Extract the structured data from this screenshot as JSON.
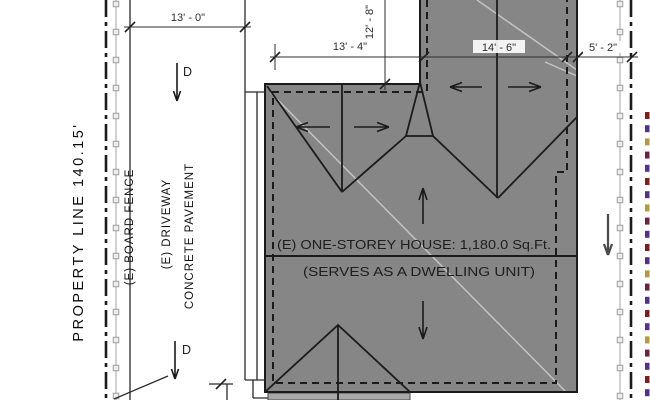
{
  "colors": {
    "background": "#ffffff",
    "house_fill": "#868686",
    "porch_fill": "#a9a9a9",
    "outline": "#1b1b1b",
    "fence": "#c2c2c2",
    "fence_post_fill": "#ededed",
    "fence_post_stroke": "#9e9e9e",
    "dim": "#2e2e2e",
    "drain_arrow": "#4a4a4a",
    "faint_roof_line": "rgba(255,255,255,0.5)"
  },
  "labels": {
    "property_line_left": "PROPERTY LINE  140.15'",
    "board_fence": "(E) BOARD FENCE",
    "driveway_line1": "(E) DRIVEWAY",
    "driveway_line2": "CONCRETE PAVEMENT",
    "house_line1": "(E) ONE-STOREY HOUSE: 1,180.0  Sq.Ft.",
    "house_line2": "(SERVES AS A DWELLING UNIT)",
    "drain_top": "D",
    "drain_bottom": "D"
  },
  "dimensions": {
    "driveway_width": "13' - 0\"",
    "left_segment": "13' - 4\"",
    "mid_segment": "14' - 6\"",
    "right_segment": "5' - 2\"",
    "upper_offset": "12' - 8\""
  },
  "fences": {
    "left_x": 116,
    "right_x": 620,
    "post_start_y": 4,
    "post_spacing": 28,
    "post_size": 5.5
  },
  "right_edge_marks": {
    "x": 645,
    "width": 4.5,
    "height": 7,
    "y_start": 112,
    "y_step": 13.2,
    "count": 22,
    "palette": [
      "#7d1d1d",
      "#553086",
      "#b39a3e",
      "#6a2440",
      "#553086"
    ]
  }
}
